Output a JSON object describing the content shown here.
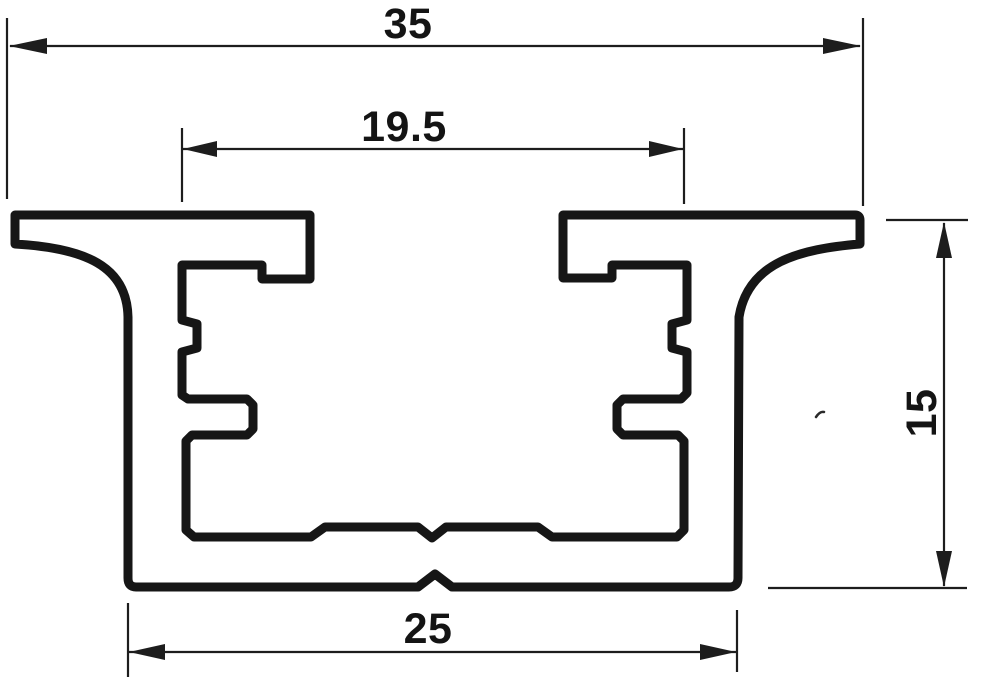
{
  "drawing": {
    "type": "technical-dimension-drawing",
    "subject": "extruded-profile-cross-section",
    "background_color": "#ffffff",
    "ink_color": "#161616",
    "dimensions": {
      "overall_width": {
        "label": "35"
      },
      "opening_width": {
        "label": "19.5"
      },
      "height": {
        "label": "15"
      },
      "base_width": {
        "label": "25"
      }
    }
  }
}
